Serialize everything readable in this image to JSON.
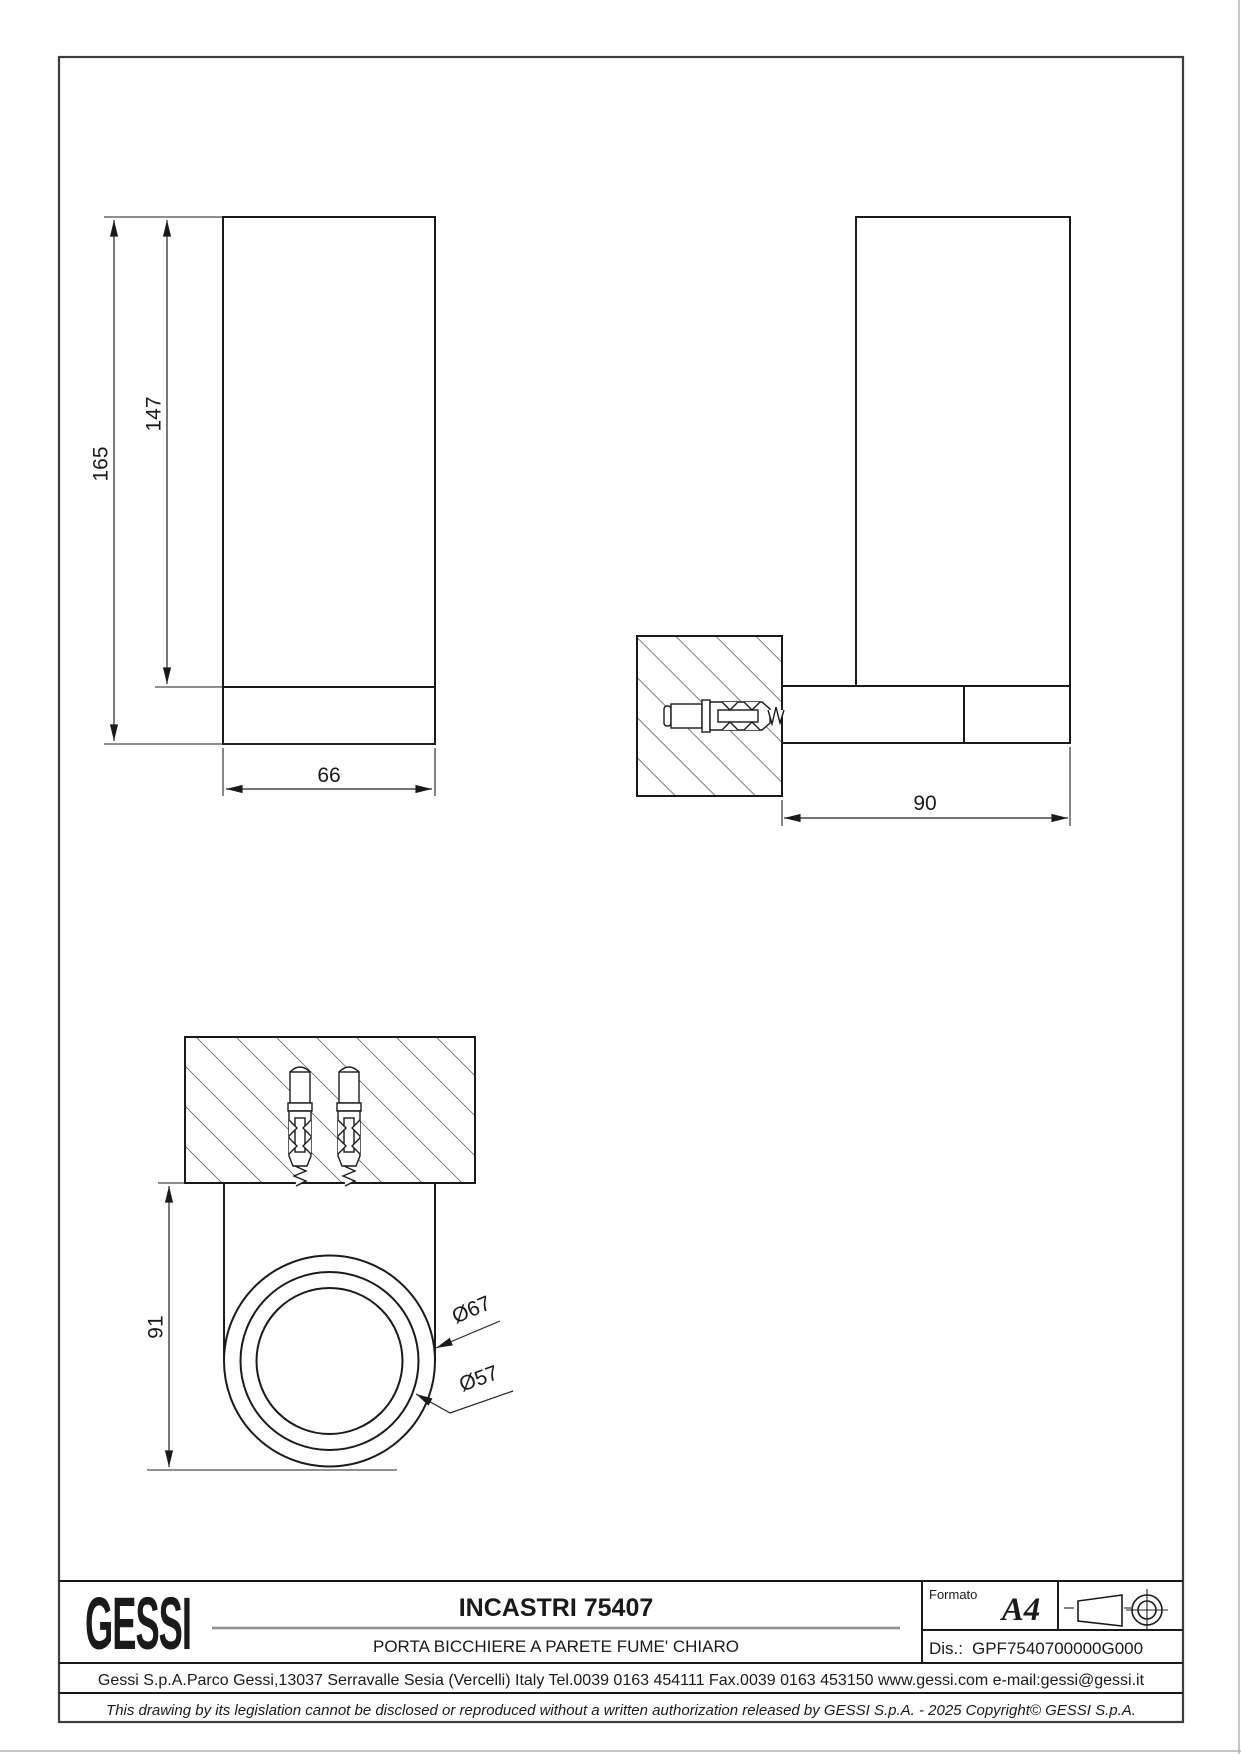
{
  "sheet": {
    "bg": "#ffffff",
    "line_color": "#1a1a1a",
    "divider_gray": "#8f8f8f"
  },
  "views": {
    "front": {
      "label": "front-view",
      "dim_total_height": "165",
      "dim_glass_height": "147",
      "dim_width": "66"
    },
    "side": {
      "label": "side-section-view",
      "dim_depth": "90"
    },
    "top": {
      "label": "top-view",
      "dim_height": "91",
      "dim_outer_diameter": "Ø67",
      "dim_glass_diameter": "Ø57"
    }
  },
  "title_block": {
    "logo_text": "GESSI",
    "title": "INCASTRI 75407",
    "subtitle": "PORTA BICCHIERE A PARETE FUME' CHIARO",
    "formato_label": "Formato",
    "formato_value": "A4",
    "dis_label": "Dis.:",
    "dis_value": "GPF7540700000G000",
    "address": "Gessi S.p.A.Parco Gessi,13037 Serravalle Sesia (Vercelli) Italy Tel.0039 0163 454111 Fax.0039 0163 453150 www.gessi.com e-mail:gessi@gessi.it",
    "legal": "This drawing by its legislation cannot be disclosed or reproduced without a written authorization released by GESSI S.p.A. - 2025 Copyright© GESSI S.p.A."
  }
}
